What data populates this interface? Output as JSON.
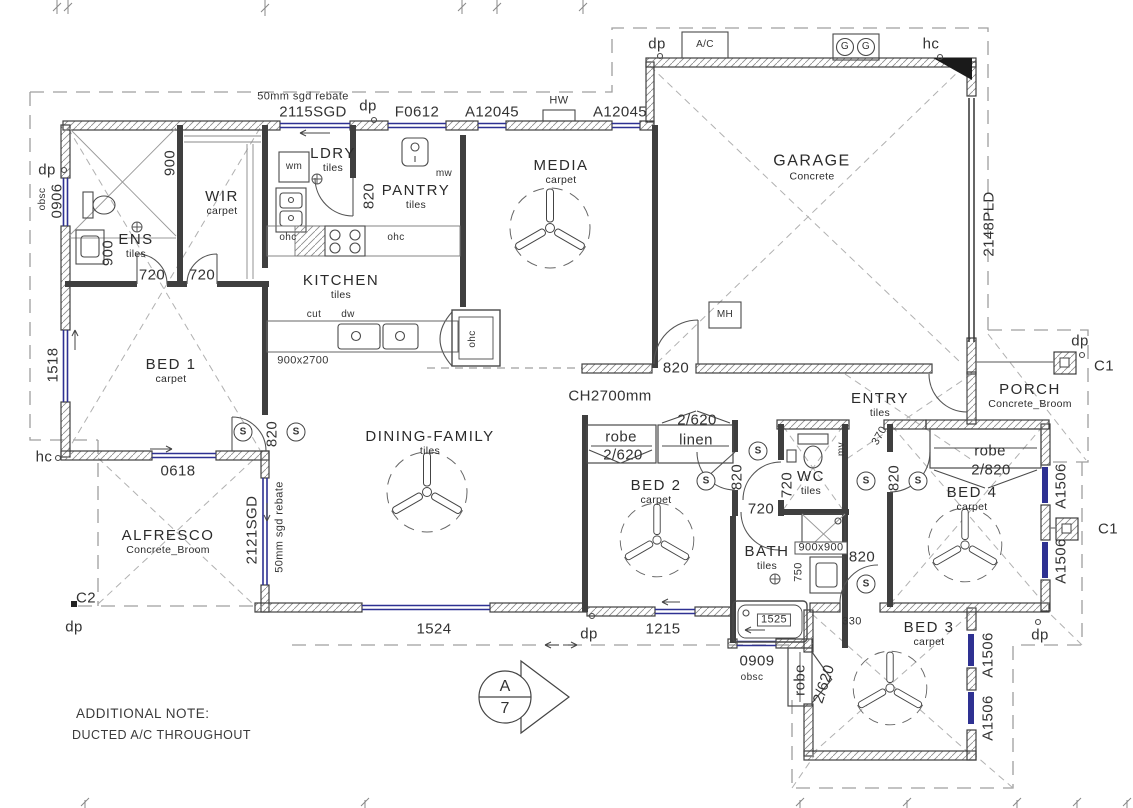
{
  "plan": {
    "note": {
      "title": "ADDITIONAL NOTE:",
      "body": "DUCTED A/C THROUGHOUT"
    },
    "ceiling": "CH2700mm",
    "rooms": [
      {
        "name": "ENS",
        "finish": "tiles"
      },
      {
        "name": "WIR",
        "finish": "carpet"
      },
      {
        "name": "LDRY",
        "finish": "tiles"
      },
      {
        "name": "PANTRY",
        "finish": "tiles"
      },
      {
        "name": "KITCHEN",
        "finish": "tiles"
      },
      {
        "name": "MEDIA",
        "finish": "carpet"
      },
      {
        "name": "GARAGE",
        "finish": "Concrete"
      },
      {
        "name": "ENTRY",
        "finish": "tiles"
      },
      {
        "name": "PORCH",
        "finish": "Concrete_Broom"
      },
      {
        "name": "DINING-FAMILY",
        "finish": "tiles"
      },
      {
        "name": "BED 1",
        "finish": "carpet"
      },
      {
        "name": "BED 2",
        "finish": "carpet"
      },
      {
        "name": "BED 3",
        "finish": "carpet"
      },
      {
        "name": "BED 4",
        "finish": "carpet"
      },
      {
        "name": "WC",
        "finish": "tiles"
      },
      {
        "name": "BATH",
        "finish": "tiles"
      },
      {
        "name": "ALFRESCO",
        "finish": "Concrete_Broom"
      }
    ],
    "openings": {
      "sgd2115": "2115SGD",
      "sgdRebate": "50mm sgd rebate",
      "f0612": "F0612",
      "a12045": "A12045",
      "pld2148": "2148PLD",
      "sgd2121": "2121SGD",
      "w0906": "0906",
      "w0618": "0618",
      "w1518": "1518",
      "w1524": "1524",
      "w1215": "1215",
      "w0909": "0909",
      "a1506": "A1506",
      "robe": "robe",
      "linen": "linen",
      "robe2620": "2/620",
      "robe2820": "2/820"
    },
    "dims": {
      "d720": "720",
      "d820": "820",
      "d370": "370",
      "d330": "330",
      "d750": "750",
      "d1525": "1525",
      "d900": "900",
      "s900": "900x900",
      "s900x2700": "900x2700"
    },
    "symbols": {
      "s": "S",
      "dp": "dp",
      "hc": "hc",
      "obsc": "obsc",
      "mv": "mv",
      "mw": "mw",
      "wm": "wm",
      "ohc": "ohc",
      "cut": "cut",
      "dw": "dw",
      "hw": "HW",
      "mh": "MH",
      "ac": "A/C",
      "g": "G",
      "c1": "C1",
      "c2": "C2",
      "sectionLetter": "A",
      "sectionNumber": "7"
    }
  }
}
